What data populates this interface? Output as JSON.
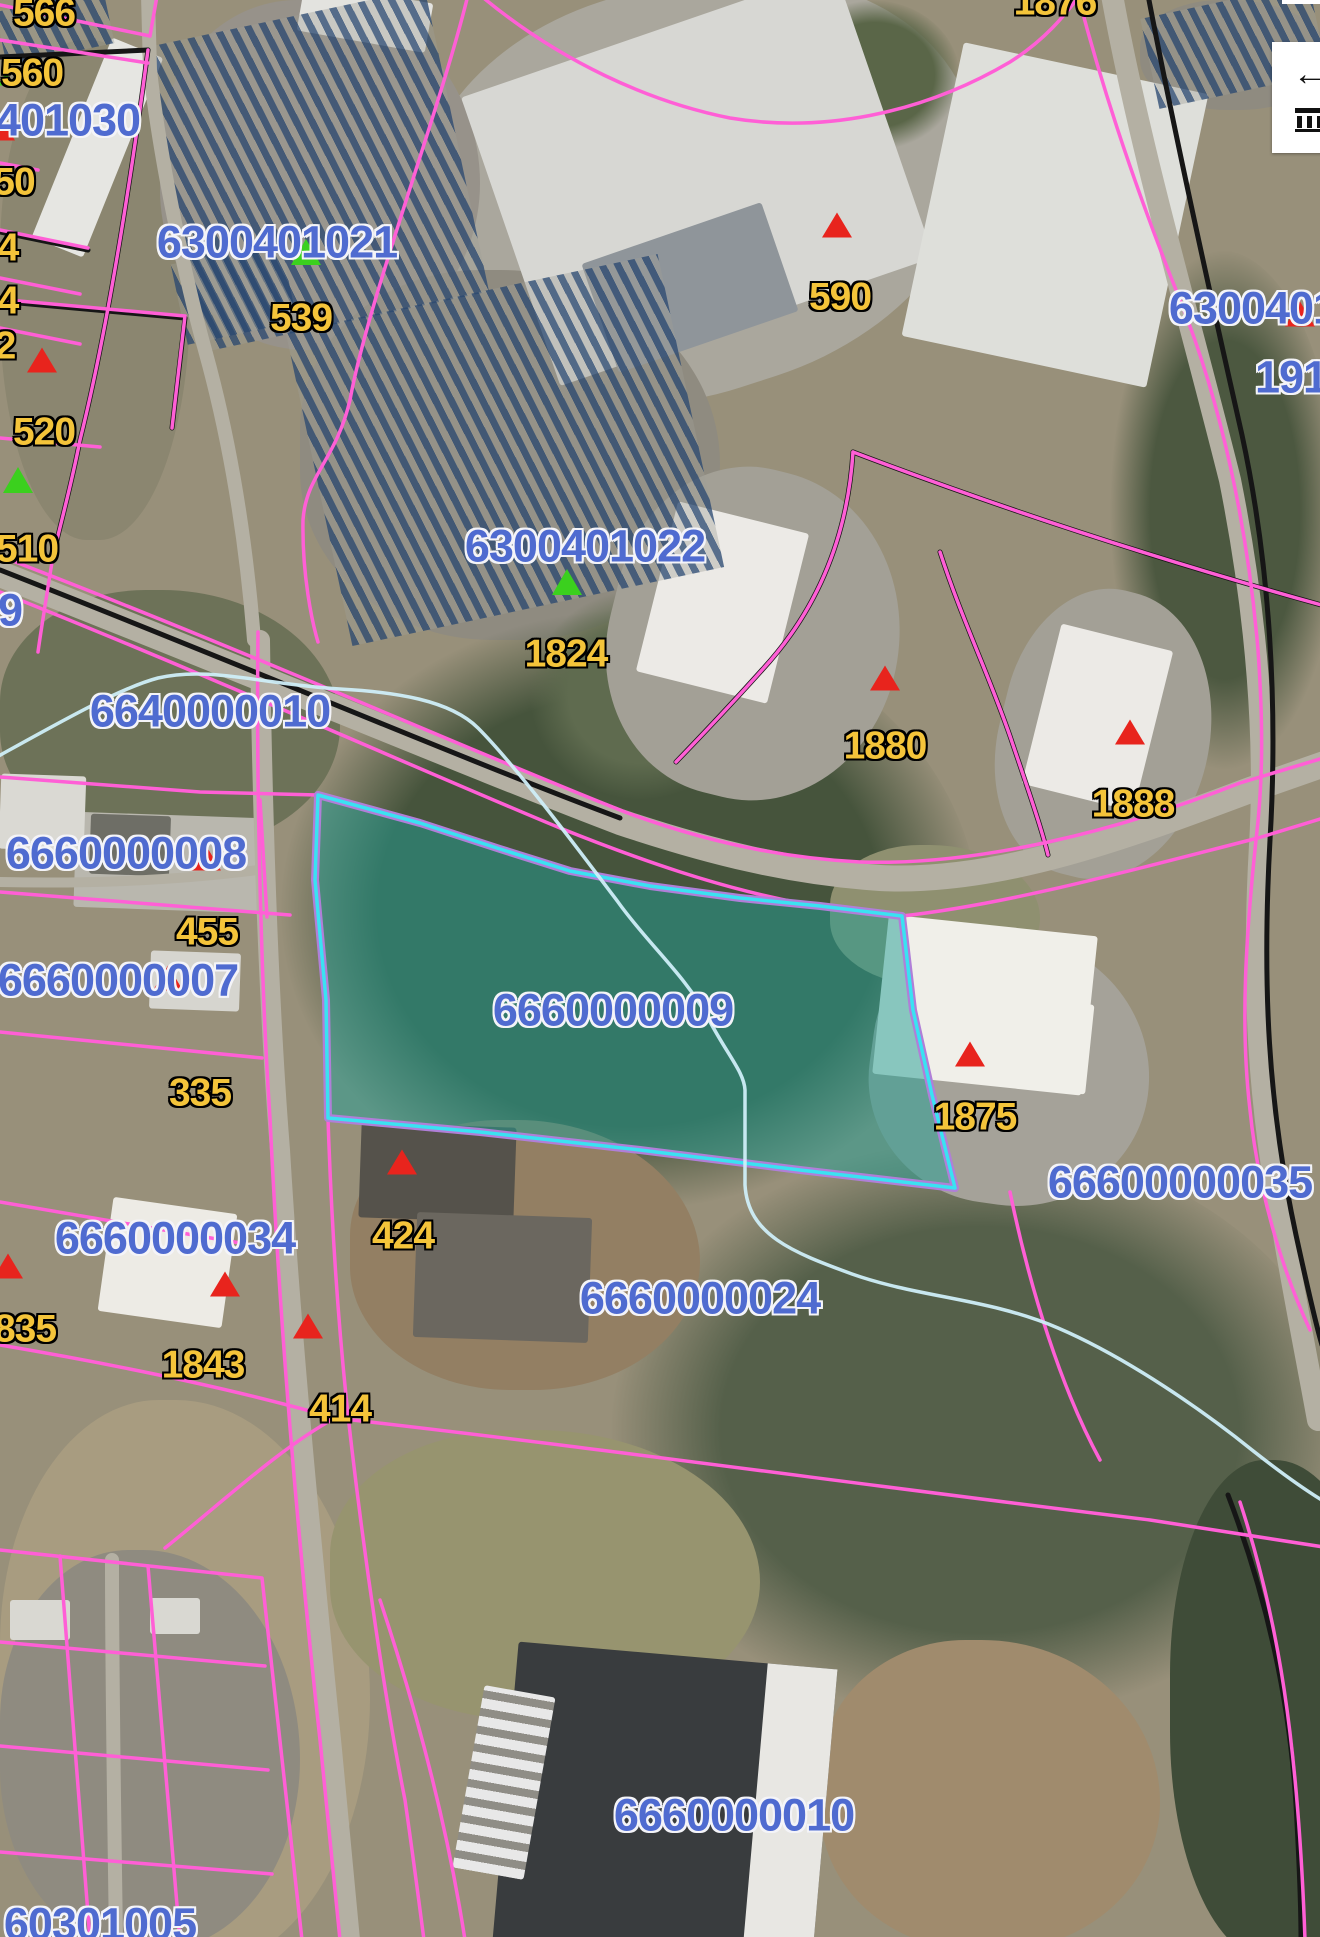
{
  "map": {
    "type": "parcel-gis-aerial-view",
    "selected_parcel": {
      "id": "6660000009"
    },
    "colors": {
      "parcel_line_pink": "#ff5fd6",
      "boundary_black": "#161616",
      "selected_outline_cyan": "#3ae2f2",
      "selected_inner_purple": "#b07fd8",
      "selected_fill_teal": "rgba(32,158,148,0.5)",
      "stream_blue": "#cfeef8",
      "parcel_id_blue": "#4f6bd0",
      "address_yellow": "#f4c43a",
      "marker_red": "#e8241d",
      "marker_green": "#3bd01e",
      "road_gray": "#b4b0a3"
    },
    "parcel_id_labels": [
      {
        "text": "401030",
        "x": 68,
        "y": 120
      },
      {
        "text": "6300401021",
        "x": 277,
        "y": 242
      },
      {
        "text": "6300401022",
        "x": 585,
        "y": 546
      },
      {
        "text": "6640000010",
        "x": 210,
        "y": 711
      },
      {
        "text": "6660000008",
        "x": 126,
        "y": 853
      },
      {
        "text": "6660000007",
        "x": 118,
        "y": 980
      },
      {
        "text": "6660000009",
        "x": 613,
        "y": 1010
      },
      {
        "text": "66600000035",
        "x": 1180,
        "y": 1182
      },
      {
        "text": "6660000034",
        "x": 175,
        "y": 1238
      },
      {
        "text": "6660000024",
        "x": 700,
        "y": 1298
      },
      {
        "text": "6660000010",
        "x": 734,
        "y": 1815
      },
      {
        "text": "60301005",
        "x": 100,
        "y": 1924
      },
      {
        "text": "9",
        "x": 10,
        "y": 610
      },
      {
        "text": "6300401",
        "x": 1253,
        "y": 308
      },
      {
        "text": "1919",
        "x": 1303,
        "y": 377
      }
    ],
    "address_labels": [
      {
        "text": "566",
        "x": 44,
        "y": 13
      },
      {
        "text": "560",
        "x": 32,
        "y": 73
      },
      {
        "text": "50",
        "x": 14,
        "y": 182
      },
      {
        "text": "4",
        "x": 8,
        "y": 248
      },
      {
        "text": "4",
        "x": 8,
        "y": 301
      },
      {
        "text": "2",
        "x": 5,
        "y": 346
      },
      {
        "text": "520",
        "x": 44,
        "y": 432
      },
      {
        "text": "510",
        "x": 27,
        "y": 549
      },
      {
        "text": "539",
        "x": 301,
        "y": 318
      },
      {
        "text": "590",
        "x": 840,
        "y": 297
      },
      {
        "text": "1824",
        "x": 566,
        "y": 654
      },
      {
        "text": "1876",
        "x": 1055,
        "y": 2
      },
      {
        "text": "1880",
        "x": 885,
        "y": 746
      },
      {
        "text": "1888",
        "x": 1133,
        "y": 804
      },
      {
        "text": "455",
        "x": 207,
        "y": 932
      },
      {
        "text": "335",
        "x": 200,
        "y": 1093
      },
      {
        "text": "424",
        "x": 403,
        "y": 1236
      },
      {
        "text": "1875",
        "x": 975,
        "y": 1117
      },
      {
        "text": "835",
        "x": 25,
        "y": 1329
      },
      {
        "text": "1843",
        "x": 203,
        "y": 1365
      },
      {
        "text": "414",
        "x": 340,
        "y": 1409
      }
    ],
    "markers": {
      "red": [
        {
          "x": 0,
          "y": 128
        },
        {
          "x": 42,
          "y": 360
        },
        {
          "x": 837,
          "y": 225
        },
        {
          "x": 885,
          "y": 678
        },
        {
          "x": 1130,
          "y": 732
        },
        {
          "x": 206,
          "y": 858
        },
        {
          "x": 168,
          "y": 978
        },
        {
          "x": 970,
          "y": 1054
        },
        {
          "x": 402,
          "y": 1162
        },
        {
          "x": 225,
          "y": 1284
        },
        {
          "x": 8,
          "y": 1266
        },
        {
          "x": 308,
          "y": 1326
        },
        {
          "x": 1300,
          "y": 314
        }
      ],
      "green": [
        {
          "x": 6,
          "y": 79,
          "size": "small"
        },
        {
          "x": 18,
          "y": 480
        },
        {
          "x": 306,
          "y": 252
        },
        {
          "x": 567,
          "y": 582
        }
      ]
    },
    "controls": {
      "pan_arrow_icon": "←"
    }
  }
}
